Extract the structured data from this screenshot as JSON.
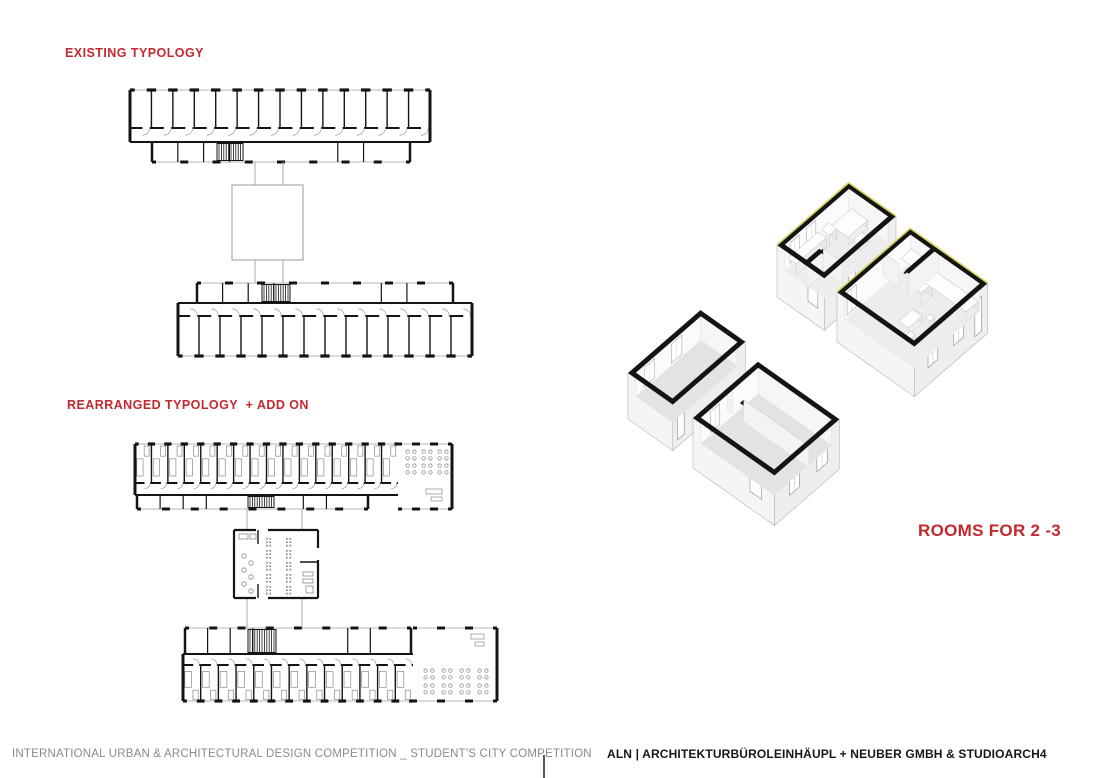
{
  "colors": {
    "accent_red": "#c2292e",
    "wall_black": "#141414",
    "line_gray": "#9a9a9a",
    "window_gray": "#b5b5b5",
    "furniture_gray": "#8a8a8a",
    "ext_wall_light": "#f5f5f5",
    "ext_wall_mid": "#eeeeee",
    "floor_gray": "#e3e3e3",
    "floor_light": "#ededed",
    "yellow_accent": "#d5cf5a",
    "footer_gray": "#8a8a8a",
    "footer_black": "#161616"
  },
  "labels": {
    "existing": "EXISTING TYPOLOGY",
    "rearranged": "REARRANGED TYPOLOGY  + ADD ON",
    "rooms_for": "ROOMS FOR 2 -3"
  },
  "footer": {
    "left": "INTERNATIONAL URBAN & ARCHITECTURAL DESIGN COMPETITION _ STUDENT'S CITY COMPETITION",
    "right": "ALN | ARCHITEKTURBÜROLEINHÄUPL + NEUBER GMBH & STUDIOARCH4"
  },
  "figures": {
    "plan_bars": [
      {
        "name": "floor-plan-existing-wing-north",
        "x": 130,
        "y": 90,
        "w": 300,
        "roomsH": 38,
        "corrH": 14,
        "rooms": 14,
        "flip": false,
        "furnished": false,
        "svc": {
          "x": 152,
          "w": 258,
          "h": 20,
          "stairX": 217,
          "stairW": 26
        }
      },
      {
        "name": "floor-plan-existing-wing-south",
        "x": 178,
        "y": 283,
        "w": 294,
        "roomsH": 40,
        "corrH": 13,
        "rooms": 14,
        "flip": true,
        "furnished": false,
        "svc": {
          "x": 197,
          "w": 256,
          "h": 20,
          "stairX": 262,
          "stairW": 28
        }
      },
      {
        "name": "floor-plan-rearranged-wing-north",
        "x": 135,
        "y": 444,
        "w": 317,
        "roomsH": 39,
        "corrH": 12,
        "rooms": 16,
        "flip": false,
        "furnished": true,
        "svc": {
          "x": 137,
          "w": 231,
          "h": 14,
          "stairX": 248,
          "stairW": 26
        },
        "common": {
          "w": 54,
          "dots": "top"
        }
      },
      {
        "name": "floor-plan-rearranged-wing-south",
        "x": 183,
        "y": 628,
        "w": 314,
        "roomsH": 36,
        "corrH": 11,
        "rooms": 13,
        "flip": true,
        "furnished": true,
        "svc": {
          "x": 185,
          "w": 226,
          "h": 26,
          "stairX": 248,
          "stairW": 28
        },
        "common": {
          "w": 84,
          "dots": "bottom"
        }
      }
    ],
    "connectors": [
      {
        "name": "connector-pavilion-existing",
        "furnished": false,
        "lines": [
          255,
          283
        ],
        "y1": 162,
        "y2": 185,
        "y3": 260,
        "y4": 283,
        "sq": {
          "x": 232,
          "y": 185,
          "w": 71,
          "h": 75
        }
      },
      {
        "name": "connector-pavilion-rearranged",
        "furnished": true,
        "lines": [
          247,
          302
        ],
        "y1": 509,
        "y2": 530,
        "y3": 598,
        "y4": 628,
        "sq": {
          "x": 234,
          "y": 530,
          "w": 84,
          "h": 68
        }
      }
    ],
    "axon_boxes": [
      {
        "name": "axon-room-existing-single",
        "o": {
          "x": 628,
          "y": 373
        },
        "L": 96,
        "W": 55,
        "h": 46,
        "fd": 24,
        "t": 5,
        "floor": "#e3e3e3",
        "yellow": false,
        "innerWinAB": [
          {
            "a": 16,
            "len": 14
          },
          {
            "a": 52,
            "len": 14
          }
        ],
        "doorsDC": [
          {
            "a": 6,
            "len": 9
          }
        ]
      },
      {
        "name": "axon-room-existing-double",
        "o": {
          "x": 693,
          "y": 418
        },
        "L": 86,
        "W": 100,
        "h": 50,
        "fd": 26,
        "t": 5,
        "floor": "#e3e3e3",
        "yellow": false,
        "parts": [
          {
            "dir": "v",
            "at": 43,
            "from": 0,
            "to": 100,
            "gaps": [
              [
                6,
                20
              ]
            ]
          }
        ],
        "innerWinAB": [
          {
            "a": 18,
            "len": 12
          }
        ],
        "winDC": [
          {
            "a": 20,
            "len": 13
          },
          {
            "a": 56,
            "len": 14
          }
        ],
        "winAD": [
          {
            "b": 70,
            "len": 14
          }
        ]
      },
      {
        "name": "axon-room-new-kitchen",
        "o": {
          "x": 777,
          "y": 245
        },
        "L": 95,
        "W": 58,
        "h": 52,
        "fd": 26,
        "t": 5,
        "floor": "#ededed",
        "yellow": true,
        "parts": [
          {
            "dir": "u",
            "at": 34,
            "from": 0,
            "to": 22
          },
          {
            "dir": "v",
            "at": 22,
            "from": 34,
            "to": 58
          }
        ],
        "innerWinAB": [
          {
            "a": 12,
            "len": 12
          },
          {
            "a": 34,
            "len": 12
          }
        ],
        "furn": [
          {
            "a": 8,
            "b": 6,
            "da": 40,
            "db": 10,
            "ht": 11
          },
          {
            "a": 52,
            "b": 6,
            "da": 10,
            "db": 10,
            "ht": 11
          },
          {
            "a": 64,
            "b": 8,
            "da": 26,
            "db": 20,
            "ht": 8
          },
          {
            "a": 66,
            "b": 32,
            "da": 12,
            "db": 8,
            "ht": 6
          }
        ],
        "doorsDC": [
          {
            "a": 32,
            "len": 9
          }
        ],
        "winAD": [
          {
            "b": 38,
            "len": 12
          }
        ]
      },
      {
        "name": "axon-room-new-double",
        "o": {
          "x": 837,
          "y": 292
        },
        "L": 97,
        "W": 95,
        "h": 50,
        "fd": 28,
        "t": 5,
        "floor": "#ededed",
        "yellow": true,
        "parts": [
          {
            "dir": "v",
            "at": 58,
            "from": 0,
            "to": 32,
            "gaps": [
              [
                20,
                30
              ]
            ]
          },
          {
            "dir": "u",
            "at": 32,
            "from": 58,
            "to": 97
          }
        ],
        "innerWinAB": [
          {
            "a": 8,
            "len": 12
          }
        ],
        "furn": [
          {
            "a": 78,
            "b": 6,
            "da": 14,
            "db": 16,
            "ht": 14
          },
          {
            "a": 62,
            "b": 36,
            "da": 14,
            "db": 10,
            "ht": 13
          },
          {
            "a": 76,
            "b": 36,
            "da": 16,
            "db": 52,
            "ht": 9
          },
          {
            "a": 30,
            "b": 48,
            "da": 18,
            "db": 12,
            "ht": 7
          },
          {
            "a": 24,
            "b": 62,
            "da": 6,
            "db": 6,
            "ht": 5
          },
          {
            "a": 50,
            "b": 62,
            "da": 6,
            "db": 6,
            "ht": 5
          }
        ],
        "winDC": [
          {
            "a": 18,
            "len": 13
          },
          {
            "a": 52,
            "len": 13
          }
        ],
        "doorsDC": [
          {
            "a": 80,
            "len": 9
          }
        ]
      }
    ]
  }
}
